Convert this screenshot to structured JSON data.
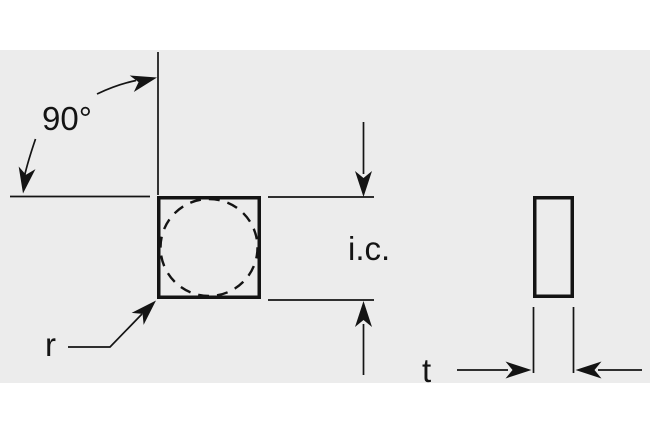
{
  "figure": {
    "type": "technical-drawing",
    "subject": "square insert top view with inscribed circle and side view thickness",
    "labels": {
      "angle": "90°",
      "inscribed_circle": "i.c.",
      "corner_radius": "r",
      "thickness": "t"
    },
    "colors": {
      "page": "#ffffff",
      "canvas": "#ececec",
      "line": "#141414"
    }
  }
}
